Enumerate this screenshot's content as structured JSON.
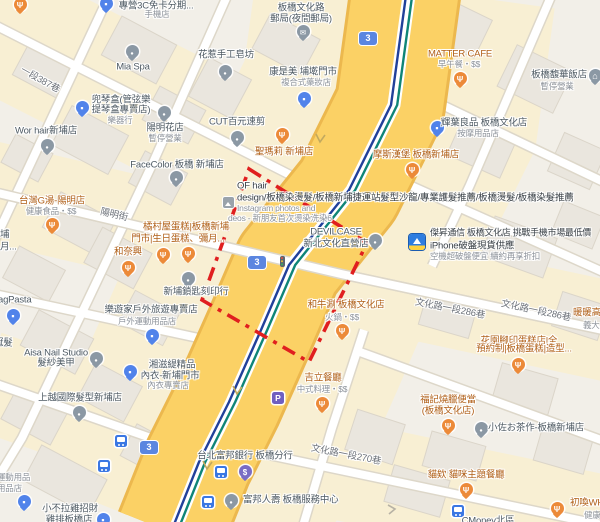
{
  "roads": {
    "shield": "3",
    "lane387": "一段387巷",
    "yangming": "陽明街",
    "lane286": "文化路一段286巷",
    "lane270": "文化路一段270巷"
  },
  "pois": {
    "sanc3": {
      "l1": "專營3C免卡分期...",
      "l2": "手機店"
    },
    "post": {
      "l1": "板橋文化路",
      "l2": "郵局(夜間郵局)"
    },
    "miaspa": {
      "l1": "Mia Spa"
    },
    "soap": {
      "l1": "花惹手工皂坊"
    },
    "cosmed": {
      "l1": "康是美 埔墘門市",
      "l2": "複合式藥妝店"
    },
    "matter": {
      "l1": "MATTER CAFE",
      "l2": "早午餐・$$"
    },
    "hotel": {
      "l1": "板橋馥華飯店",
      "l2": "暫停營業"
    },
    "violin": {
      "l1": "兜琴盒(管弦樂",
      "l2": "提琴盒專賣店)",
      "l3": "樂器行"
    },
    "worhair": {
      "l1": "Wor hair新埔店"
    },
    "flower": {
      "l1": "陽明花店",
      "l2": "暫停營業"
    },
    "cut": {
      "l1": "CUT百元速剪"
    },
    "stmary": {
      "l1": "聖瑪莉 新埔店"
    },
    "facecolor": {
      "l1": "FaceColor 板橋 新埔店"
    },
    "mos": {
      "l1": "摩斯漢堡 板橋新埔店"
    },
    "hueiyeh": {
      "l1": "輝葉良品 板橋文化店",
      "l2": "按摩用品店"
    },
    "gtang": {
      "l1": "台灣G湯-陽明店",
      "l2": "健康食品・$$"
    },
    "kitamura": {
      "l1": "橘村屋蛋糕|板橋新埔",
      "l2": "門市|生日蛋糕、彌月..."
    },
    "hetaixing": {
      "l1": "和奈興"
    },
    "ofhair": {
      "l1": "OF hair",
      "l2": "design/板橋染燙髮/板橋新埔捷運站髮型沙龍/專業護髮推薦/板橋燙髮/板橋染髮推薦",
      "l3": "Instagram photos and",
      "l4": "deos - 新朋友首次燙染洗染6"
    },
    "devilcase": {
      "l1": "DEVILCASE",
      "l2": "新北文化直營店"
    },
    "jiesheng": {
      "l1": "傑昇通信 板橋文化店 挑戰手機市場最低價",
      "l2": "iPhone破盤現貨供應",
      "l3": "空機超破盤便宜 續約再享折扣"
    },
    "locksmith": {
      "l1": "新埔鎖匙刻印行"
    },
    "outdoor": {
      "l1": "樂遊家戶外旅遊專賣店",
      "l2": "戶外運動用品店"
    },
    "agpasta": {
      "l1": "agPasta"
    },
    "wagyu": {
      "l1": "和牛涮 板橋文化店",
      "l2": "火鍋・$$"
    },
    "nuannuan": {
      "l1": "暖暖高",
      "l2": "義大"
    },
    "garden": {
      "l1": "花園腳印蛋糕店|全",
      "l2": "預約制|板橋蛋糕|造型..."
    },
    "aisa": {
      "l1": "Aisa Nail Studio",
      "l2": "髮紗美甲"
    },
    "lingerie": {
      "l1": "湘滋緹精品",
      "l2": "內衣-新埔門市",
      "l3": "內衣專賣店"
    },
    "shangyue": {
      "l1": "上越國際髮型新埔店"
    },
    "jili": {
      "l1": "吉立餐廳",
      "l2": "中式料理・$$"
    },
    "fuji": {
      "l1": "福記燒臘便當",
      "l2": "(板橋文化店)"
    },
    "kosa": {
      "l1": "小佐お茶作-板橋新埔店"
    },
    "cat": {
      "l1": "貓欸 貓咪主題餐廳"
    },
    "chuhuan": {
      "l1": "初喚WHA",
      "l2": "健康"
    },
    "fubon_bank": {
      "l1": "台北富邦銀行 板橋分行"
    },
    "fubon_life": {
      "l1": "富邦人壽 板橋服務中心"
    },
    "chicken": {
      "l1": "小不拉雞招財",
      "l2": "雞排板橋店"
    },
    "cmoney": {
      "l1": "CMoney北區"
    }
  },
  "fragments": {
    "pu": "埔",
    "yue": "月...",
    "guanfa": "冠髮",
    "sport1": "運動用品",
    "sport2": "用品店"
  },
  "icons": {
    "restaurant-pin": "fork-and-knife",
    "shopping-pin": "bag",
    "generic-pin": "dot",
    "bank-pin": "dollar",
    "mail-pin": "envelope",
    "hotel-pin": "house",
    "bus-stop-icon": "bus",
    "parking-icon": "P",
    "traffic-light-icon": "traffic-light",
    "photo-icon": "photo-thumbnail",
    "store-logo-icon": "jiesheng-logo",
    "route-shield": "3"
  },
  "colors": {
    "highway_fill": "#fbd165",
    "boundary_red": "#e01f1f",
    "transit_line_1": "#21409a",
    "transit_line_2": "#0f8577",
    "food_label": "#b05f17",
    "road_label": "#6d727a"
  }
}
